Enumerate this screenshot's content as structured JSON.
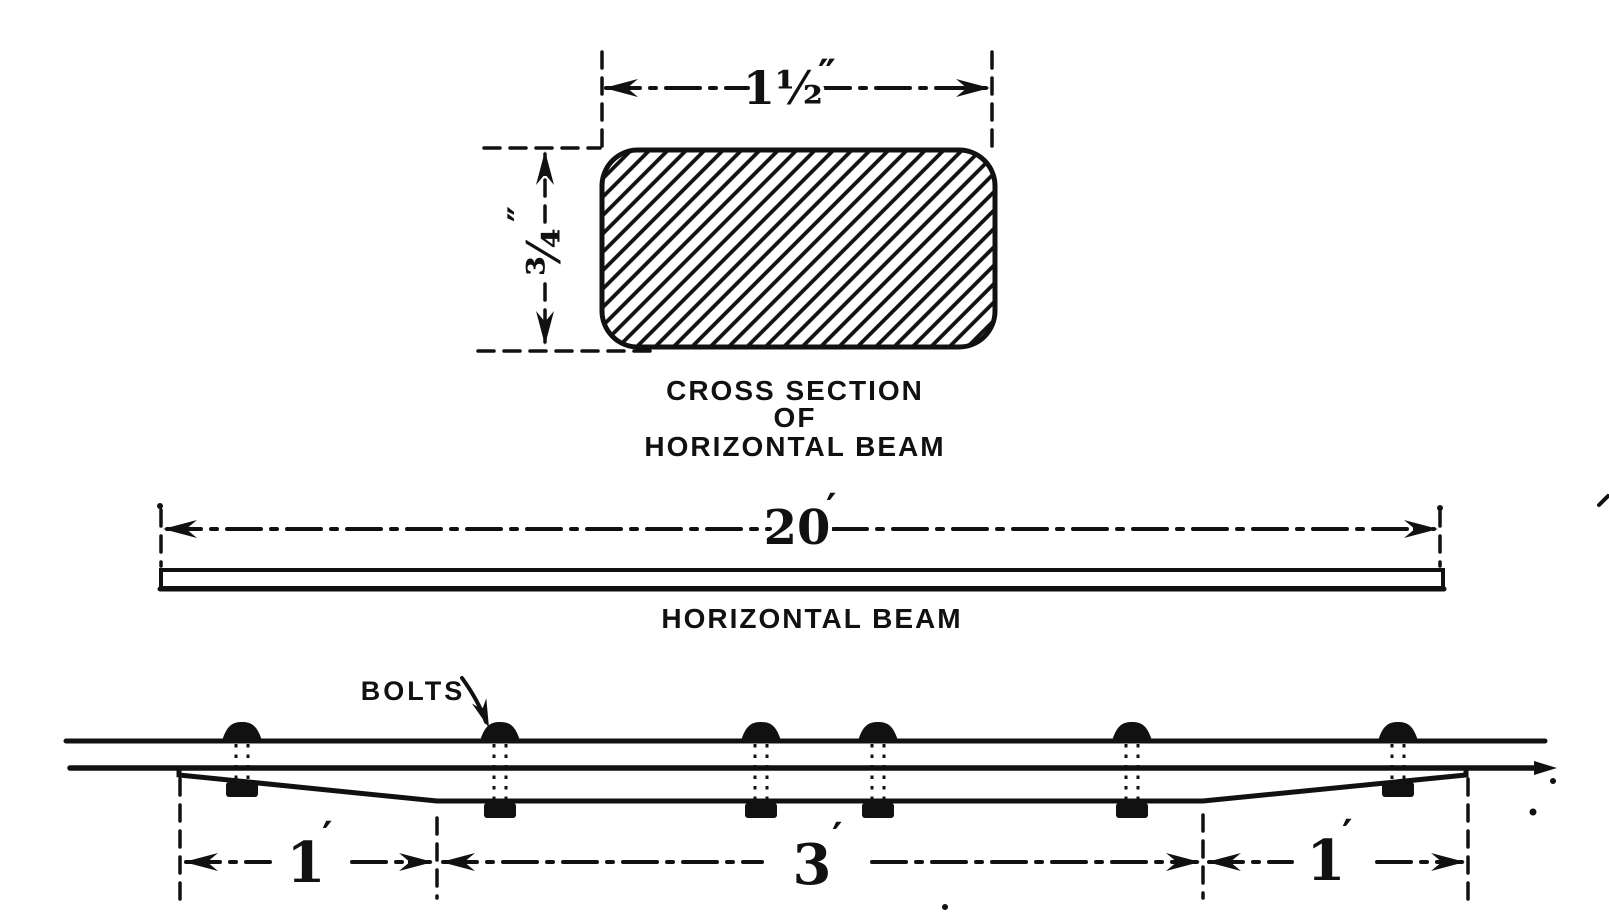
{
  "figure": {
    "kind": "engineering-drawing",
    "colors": {
      "ink": "#111111",
      "paper": "#ffffff"
    }
  },
  "cross_section": {
    "width_value": "1½",
    "width_unit": "″",
    "height_value": "¾",
    "height_unit": "″",
    "caption": [
      "CROSS SECTION",
      "OF",
      "HORIZONTAL BEAM"
    ]
  },
  "side_view": {
    "length_value": "20",
    "length_unit": "′",
    "caption": "HORIZONTAL BEAM"
  },
  "bolt_view": {
    "label": "BOLTS",
    "left_dim_value": "1",
    "left_dim_unit": "′",
    "middle_dim_value": "3",
    "middle_dim_unit": "′",
    "right_dim_value": "1",
    "right_dim_unit": "′",
    "bolt_count": 6,
    "bolts": [
      {
        "x": 242,
        "nut_y": 781
      },
      {
        "x": 500,
        "nut_y": 802
      },
      {
        "x": 761,
        "nut_y": 802
      },
      {
        "x": 878,
        "nut_y": 802
      },
      {
        "x": 1132,
        "nut_y": 802
      },
      {
        "x": 1398,
        "nut_y": 781
      }
    ]
  }
}
